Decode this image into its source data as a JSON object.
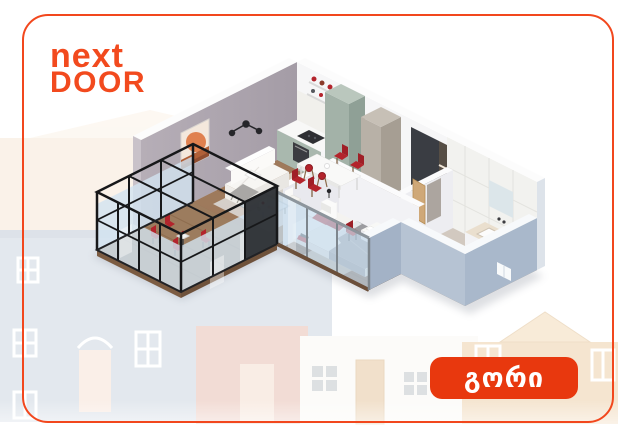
{
  "card": {
    "background": "#ffffff",
    "border_color": "#f2471d"
  },
  "logo": {
    "line1": "next",
    "line2": "DOOR",
    "color": "#f24a1e"
  },
  "location_badge": {
    "label": "გორი",
    "background": "#e8380e",
    "text_color": "#ffffff"
  },
  "floorplan": {
    "kind": "isometric-3d-apartment-render",
    "rooms": [
      "living-room",
      "kitchen",
      "dining-area",
      "hallway",
      "bedroom",
      "bathroom",
      "balcony"
    ],
    "palette": {
      "wood_floor": "#8a6750",
      "dark_wood_floor": "#6f4f3b",
      "living_wall": "#a89fa9",
      "white_wall": "#f6f6f7",
      "exterior_wall": "#a9b8cb",
      "kitchen_cabinets": "#a3b2a8",
      "accent_red": "#b3242c",
      "balcony_frame": "#17181a",
      "glass": "#cfe2ef"
    }
  },
  "background_illustration": {
    "kind": "faint-house-facades",
    "colors": [
      "#f7e9d8",
      "#cdd7e1",
      "#e9c0b4",
      "#fbf8f5",
      "#eed0ab"
    ]
  }
}
